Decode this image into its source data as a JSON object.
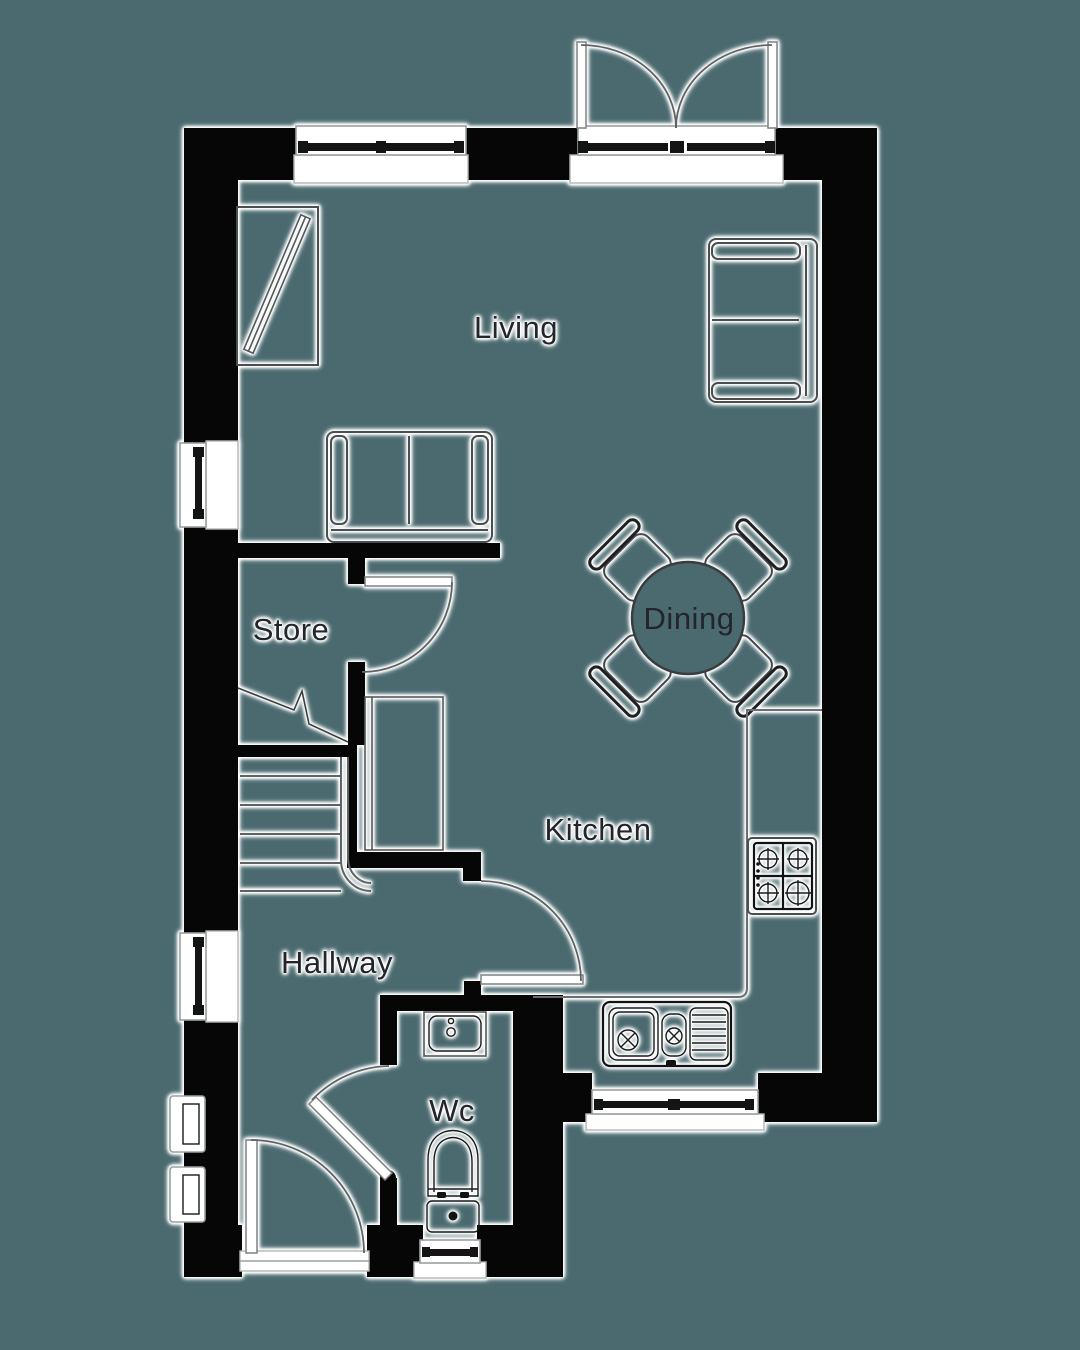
{
  "page": {
    "background_color": "#4a6a6f",
    "type": "floor-plan",
    "floor": "ground-floor"
  },
  "plan": {
    "wall_color": "#060606",
    "line_halo_color": "#ffffff",
    "label_color": "#23252b",
    "rooms": [
      {
        "id": "living",
        "label": "Living"
      },
      {
        "id": "store",
        "label": "Store"
      },
      {
        "id": "dining",
        "label": "Dining"
      },
      {
        "id": "kitchen",
        "label": "Kitchen"
      },
      {
        "id": "hallway",
        "label": "Hallway"
      },
      {
        "id": "wc",
        "label": "Wc"
      }
    ],
    "fixtures": [
      "tv-unit",
      "sofa-two-seat-east",
      "sofa-two-seat-store-wall",
      "dining-table-round",
      "dining-chair-x4",
      "staircase",
      "under-stair-cupboard",
      "kitchen-counter",
      "hob-4-burner",
      "sink-double-drainer",
      "wc-basin",
      "wc-toilet"
    ],
    "openings": [
      "french-doors-top",
      "window-top-living",
      "window-west-living",
      "window-west-hallway",
      "sidelight-window-x2",
      "window-kitchen-bottom",
      "window-wc-bottom",
      "front-door",
      "store-door",
      "kitchen-door",
      "wc-door"
    ]
  }
}
